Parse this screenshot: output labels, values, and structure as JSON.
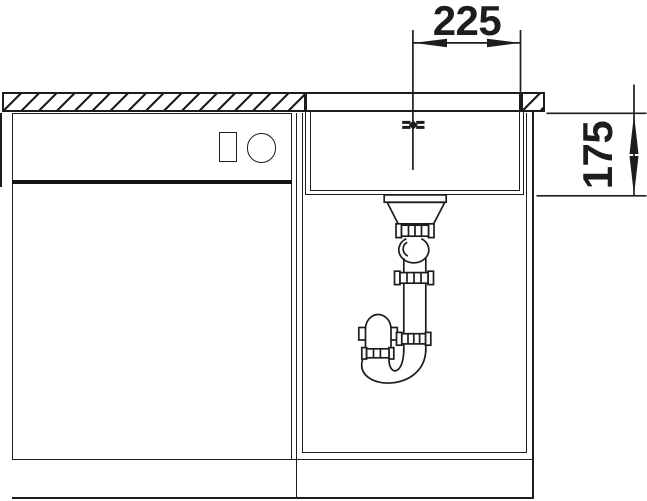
{
  "drawing": {
    "description": "Sectional installation drawing: undermount sink bowl with drain strainer and siphon trap inside a base cabinet, adjacent appliance front with control panel at left, hatched worktop on top",
    "dims": {
      "horizontal": "225",
      "vertical": "175"
    },
    "colors": {
      "line": "#1d1d1b",
      "background": "#ffffff"
    }
  }
}
